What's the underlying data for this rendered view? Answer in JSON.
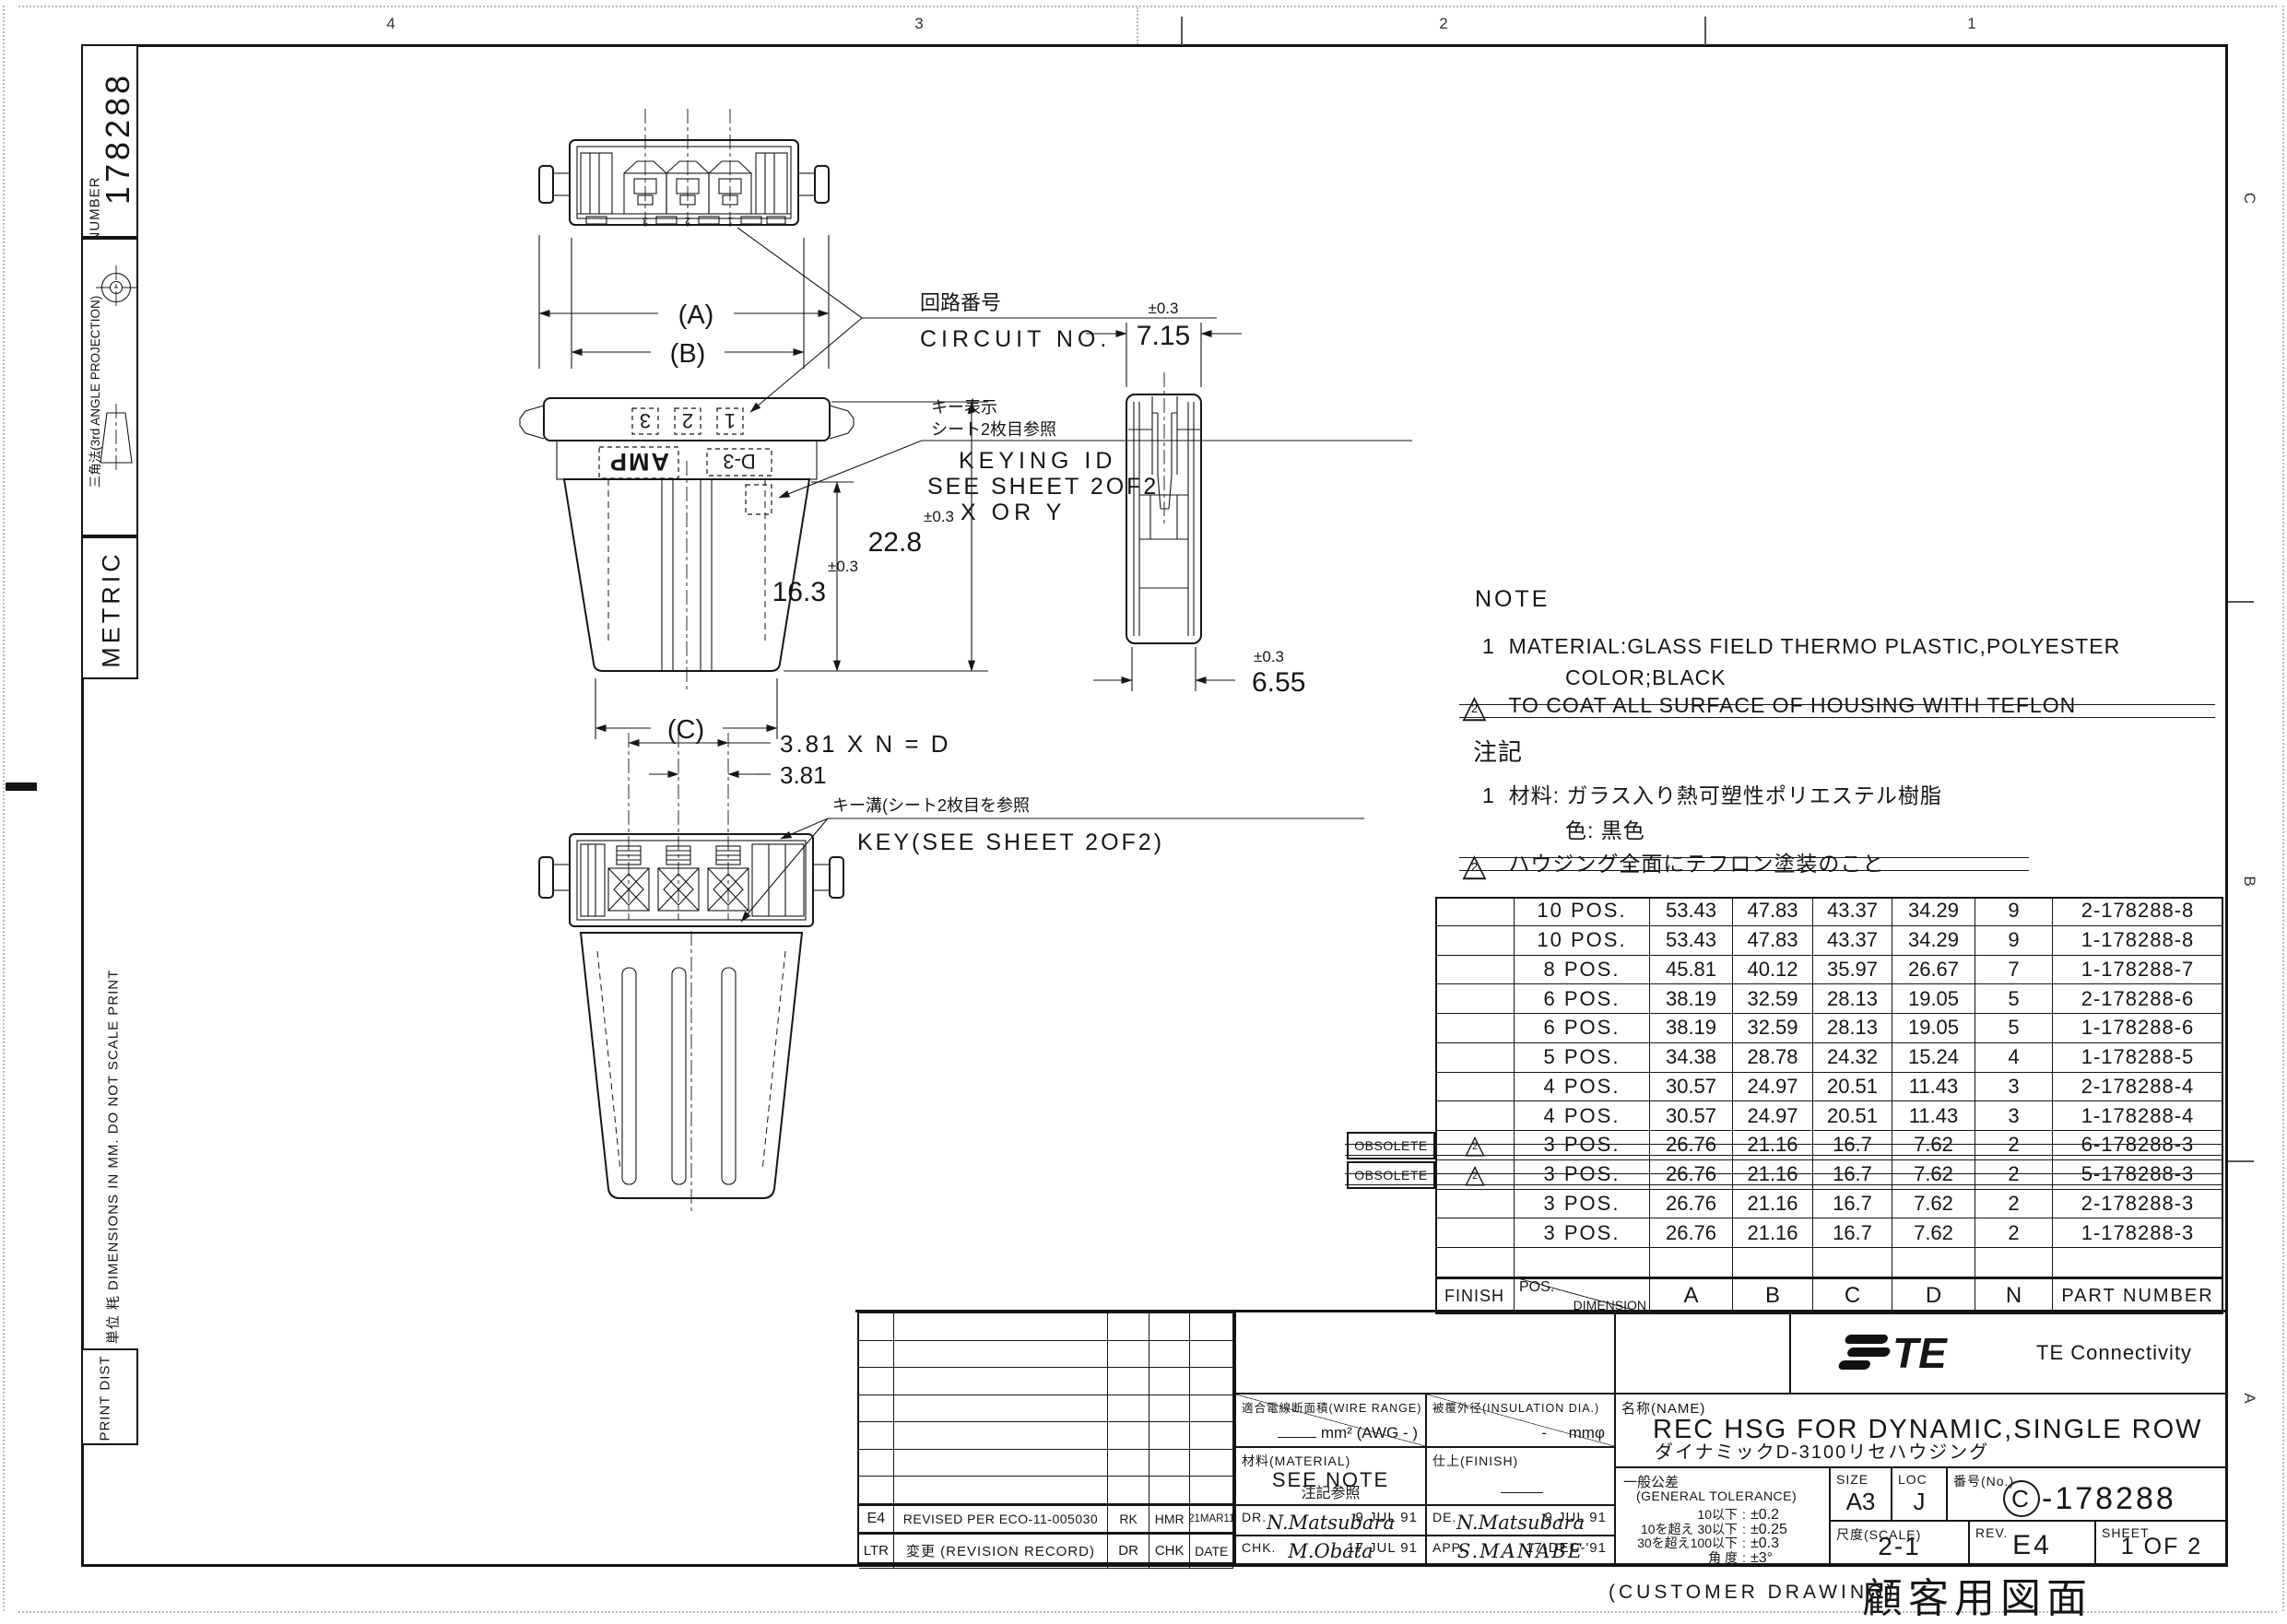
{
  "zones": {
    "top": [
      "4",
      "3",
      "2",
      "1"
    ],
    "right": [
      "C",
      "B",
      "A"
    ]
  },
  "sidebar": {
    "number_label": "NUMBER",
    "number_value": "178288",
    "projection_label": "三角法(3rd ANGLE PROJECTION)",
    "metric_label": "METRIC",
    "units_note": "単位 粍 DIMENSIONS IN MM. DO NOT SCALE PRINT",
    "print_dist": "PRINT DIST"
  },
  "drawing": {
    "labels": {
      "circuit_jp": "回路番号",
      "circuit_en": "CIRCUIT NO.",
      "keying_jp1": "キー表示",
      "keying_jp2": "シート2枚目参照",
      "keying_en1": "KEYING ID",
      "keying_en2": "SEE SHEET 2OF2",
      "keying_en3": "X OR Y",
      "key_jp": "キー溝(シート2枚目を参照",
      "key_en": "KEY(SEE SHEET 2OF2)",
      "amp": "AMP",
      "keymark": "D-3",
      "pos_numbers": [
        "3",
        "2",
        "1"
      ]
    },
    "dims": {
      "a": "(A)",
      "b": "(B)",
      "c": "(C)",
      "h_outer": "22.8",
      "h_inner": "16.3",
      "w_top": "7.15",
      "w_bottom": "6.55",
      "tol": "±0.3",
      "pitch_formula": "3.81 X N = D",
      "pitch": "3.81"
    }
  },
  "note": {
    "title": "NOTE",
    "item1_no": "1",
    "item1a": "MATERIAL:GLASS FIELD THERMO PLASTIC,POLYESTER",
    "item1b": "COLOR;BLACK",
    "item2": "TO COAT ALL SURFACE OF HOUSING WITH TEFLON",
    "title_jp": "注記",
    "item1_jp_no": "1",
    "item1a_jp": "材料: ガラス入り熱可塑性ポリエステル樹脂",
    "item1b_jp": "色: 黒色",
    "item2_jp": "ハウジング全面にテフロン塗装のこと",
    "marker": "2"
  },
  "parts_table": {
    "obsolete_label": "OBSOLETE",
    "header": {
      "finish": "FINISH",
      "pos": "POS.",
      "dimension": "DIMENSION",
      "a": "A",
      "b": "B",
      "c": "C",
      "d": "D",
      "n": "N",
      "part": "PART NUMBER"
    },
    "rows": [
      {
        "finish": "",
        "marker": "",
        "obsolete": false,
        "struck": false,
        "pos": "10 POS.",
        "a": "53.43",
        "b": "47.83",
        "c": "43.37",
        "d": "34.29",
        "n": "9",
        "part": "2-178288-8"
      },
      {
        "finish": "",
        "marker": "",
        "obsolete": false,
        "struck": false,
        "pos": "10 POS.",
        "a": "53.43",
        "b": "47.83",
        "c": "43.37",
        "d": "34.29",
        "n": "9",
        "part": "1-178288-8"
      },
      {
        "finish": "",
        "marker": "",
        "obsolete": false,
        "struck": false,
        "pos": "8 POS.",
        "a": "45.81",
        "b": "40.12",
        "c": "35.97",
        "d": "26.67",
        "n": "7",
        "part": "1-178288-7"
      },
      {
        "finish": "",
        "marker": "",
        "obsolete": false,
        "struck": false,
        "pos": "6 POS.",
        "a": "38.19",
        "b": "32.59",
        "c": "28.13",
        "d": "19.05",
        "n": "5",
        "part": "2-178288-6"
      },
      {
        "finish": "",
        "marker": "",
        "obsolete": false,
        "struck": false,
        "pos": "6 POS.",
        "a": "38.19",
        "b": "32.59",
        "c": "28.13",
        "d": "19.05",
        "n": "5",
        "part": "1-178288-6"
      },
      {
        "finish": "",
        "marker": "",
        "obsolete": false,
        "struck": false,
        "pos": "5 POS.",
        "a": "34.38",
        "b": "28.78",
        "c": "24.32",
        "d": "15.24",
        "n": "4",
        "part": "1-178288-5"
      },
      {
        "finish": "",
        "marker": "",
        "obsolete": false,
        "struck": false,
        "pos": "4 POS.",
        "a": "30.57",
        "b": "24.97",
        "c": "20.51",
        "d": "11.43",
        "n": "3",
        "part": "2-178288-4"
      },
      {
        "finish": "",
        "marker": "",
        "obsolete": false,
        "struck": false,
        "pos": "4 POS.",
        "a": "30.57",
        "b": "24.97",
        "c": "20.51",
        "d": "11.43",
        "n": "3",
        "part": "1-178288-4"
      },
      {
        "finish": "",
        "marker": "2",
        "obsolete": true,
        "struck": true,
        "pos": "3 POS.",
        "a": "26.76",
        "b": "21.16",
        "c": "16.7",
        "d": "7.62",
        "n": "2",
        "part": "6-178288-3"
      },
      {
        "finish": "",
        "marker": "2",
        "obsolete": true,
        "struck": true,
        "pos": "3 POS.",
        "a": "26.76",
        "b": "21.16",
        "c": "16.7",
        "d": "7.62",
        "n": "2",
        "part": "5-178288-3"
      },
      {
        "finish": "",
        "marker": "",
        "obsolete": false,
        "struck": false,
        "pos": "3 POS.",
        "a": "26.76",
        "b": "21.16",
        "c": "16.7",
        "d": "7.62",
        "n": "2",
        "part": "2-178288-3"
      },
      {
        "finish": "",
        "marker": "",
        "obsolete": false,
        "struck": false,
        "pos": "3 POS.",
        "a": "26.76",
        "b": "21.16",
        "c": "16.7",
        "d": "7.62",
        "n": "2",
        "part": "1-178288-3"
      },
      {
        "finish": "",
        "marker": "",
        "obsolete": false,
        "struck": false,
        "pos": "",
        "a": "",
        "b": "",
        "c": "",
        "d": "",
        "n": "",
        "part": ""
      }
    ]
  },
  "revision": {
    "empty_count": 7,
    "entry": {
      "ltr": "E4",
      "desc": "REVISED PER ECO-11-005030",
      "dr": "RK",
      "chk": "HMR",
      "date": "21MAR11"
    },
    "header": {
      "ltr": "LTR",
      "desc": "変更 (REVISION RECORD)",
      "dr": "DR",
      "chk": "CHK",
      "date": "DATE"
    }
  },
  "title_block": {
    "wire_label": "適合電線断面積(WIRE RANGE)",
    "wire_value": "mm² (AWG - )",
    "ins_label": "被覆外径(INSULATION DIA.)",
    "ins_dash": "-",
    "ins_unit": "mmφ",
    "mat_label": "材料(MATERIAL)",
    "mat_value": "SEE NOTE",
    "mat_value_jp": "注記参照",
    "fin_label": "仕上(FINISH)",
    "dr_label": "DR.",
    "dr_date": "9 JUL 91",
    "dr_sig": "N.Matsubara",
    "de_label": "DE.",
    "de_date": "9 JUL 91",
    "de_sig": "N.Matsubara",
    "chk_label": "CHK.",
    "chk_date": "17 JUL 91",
    "chk_sig": "M.Obata",
    "app_label": "APP.",
    "app_date": "17-DEC-'91",
    "app_sig": "S.MANABE",
    "name_label": "名称(NAME)",
    "name_en": "REC HSG FOR DYNAMIC,SINGLE ROW",
    "name_jp": "ダイナミックD-3100リセハウジング",
    "brand": "TE Connectivity",
    "tol_label": "一般公差",
    "tol_label_en": "(GENERAL TOLERANCE)",
    "tol_rows": [
      {
        "range": "10以下",
        "value": "±0.2"
      },
      {
        "range": "10を超え 30以下",
        "value": "±0.25"
      },
      {
        "range": "30を超え100以下",
        "value": "±0.3"
      },
      {
        "range": "角 度",
        "value": "±3°"
      }
    ],
    "size_label": "SIZE",
    "size_value": "A3",
    "loc_label": "LOC",
    "loc_value": "J",
    "no_label": "番号(No.)",
    "no_c": "C",
    "no_rest": "-178288",
    "scale_label": "尺度(SCALE)",
    "scale_value": "2-1",
    "rev_label": "REV.",
    "rev_value": "E4",
    "sheet_label": "SHEET",
    "sheet_value": "1 OF 2"
  },
  "footer": {
    "en": "(CUSTOMER DRAWING)",
    "jp": "顧客用図面"
  }
}
